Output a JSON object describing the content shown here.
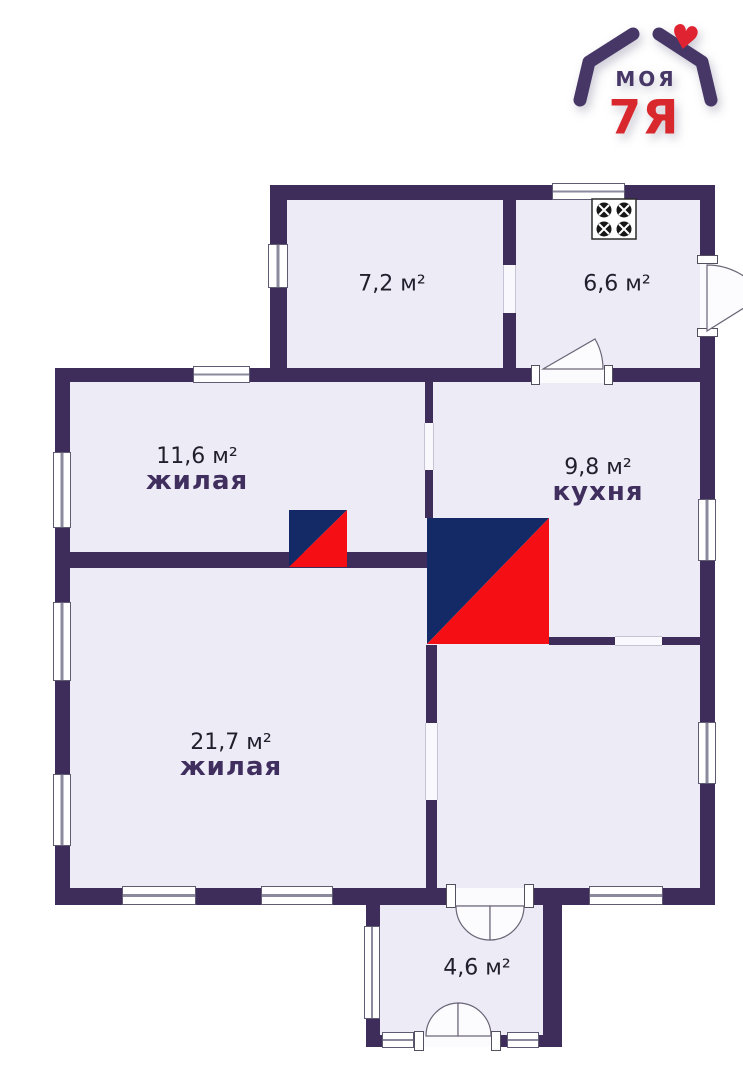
{
  "page": {
    "background": "#ffffff",
    "type": "floor-plan"
  },
  "logo": {
    "brand_line1": "МОЯ",
    "brand_line2": "7Я",
    "heart": "♥",
    "color_purple": "#473767",
    "color_red": "#d9272e"
  },
  "rooms": {
    "room_7_2": {
      "area": "7,2 м²",
      "label": ""
    },
    "room_6_6": {
      "area": "6,6 м²",
      "label": ""
    },
    "room_11_6": {
      "area": "11,6 м²",
      "label": "жилая"
    },
    "kitchen": {
      "area": "9,8 м²",
      "label": "кухня"
    },
    "room_21_7": {
      "area": "21,7 м²",
      "label": "жилая"
    },
    "hallway": {
      "area": "4,6 м²",
      "label": ""
    }
  },
  "symbols": {
    "stove": "stove-icon",
    "furnace_large": "furnace-icon",
    "furnace_small": "furnace-icon",
    "heart": "heart-icon"
  },
  "colors": {
    "wall": "#3e2c5a",
    "room_fill": "#ecebf6",
    "furnace_navy": "#132a66",
    "furnace_red": "#f50f14",
    "window_white": "#ffffff"
  }
}
